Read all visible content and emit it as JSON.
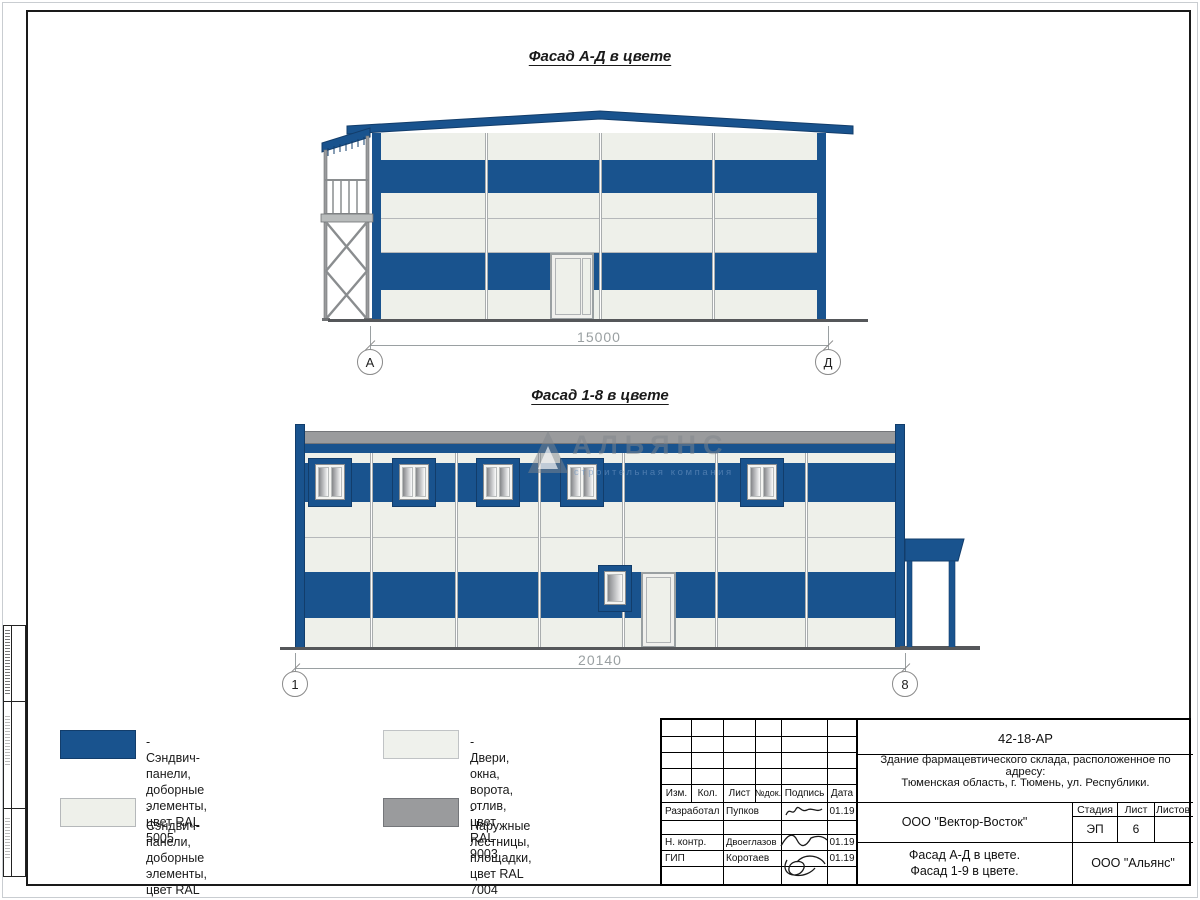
{
  "sheet": {
    "facade_ad": {
      "title": "Фасад А-Д в цвете",
      "dimension": "15000",
      "axis_left": "А",
      "axis_right": "Д"
    },
    "facade_18": {
      "title": "Фасад 1-8 в цвете",
      "dimension": "20140",
      "axis_left": "1",
      "axis_right": "8"
    },
    "watermark": {
      "name": "АЛЬЯНС",
      "tagline": "строительная компания"
    },
    "legend": {
      "items": [
        {
          "line1": "- Сэндвич-панели, доборные",
          "line2": "элементы, цвет RAL 5005"
        },
        {
          "line1": "- Сэндвич-панели, доборные",
          "line2": "элементы, цвет RAL 9003"
        },
        {
          "line1": "- Двери, окна, ворота, отлив,",
          "line2": "цвет RAL 9003"
        },
        {
          "line1": "- Наружные лестницы,",
          "line2": "площадки, цвет RAL 7004"
        }
      ]
    },
    "titleblock": {
      "code": "42-18-АР",
      "desc1": "Здание фармацевтического склада, расположенное по адресу:",
      "desc2": "Тюменская область, г. Тюмень, ул. Республики.",
      "col_izm": "Изм.",
      "col_kol": "Кол.",
      "col_list": "Лист",
      "col_ndok": "№док.",
      "col_podpis": "Подпись",
      "col_data": "Дата",
      "row1_role": "Разработал",
      "row1_name": "Пупков",
      "row1_date": "01.19",
      "row2_role": "Н. контр.",
      "row2_name": "Двоеглазов",
      "row2_date": "01.19",
      "row3_role": "ГИП",
      "row3_name": "Коротаев",
      "row3_date": "01.19",
      "company": "ООО \"Вектор-Восток\"",
      "stage_label": "Стадия",
      "sheet_label": "Лист",
      "sheets_label": "Листов",
      "stage": "ЭП",
      "sheet_no": "6",
      "sheets_total": "",
      "sheet_title1": "Фасад А-Д в цвете.",
      "sheet_title2": "Фасад 1-9 в цвете.",
      "org": "ООО \"Альянс\""
    }
  },
  "colors": {
    "panel_blue_ral5005": "#19538e",
    "panel_white_ral9003": "#eef0ea",
    "gray_ral7004": "#9a9b9d",
    "ground": "#55575a",
    "dimension_gray": "#9aa0a2"
  }
}
